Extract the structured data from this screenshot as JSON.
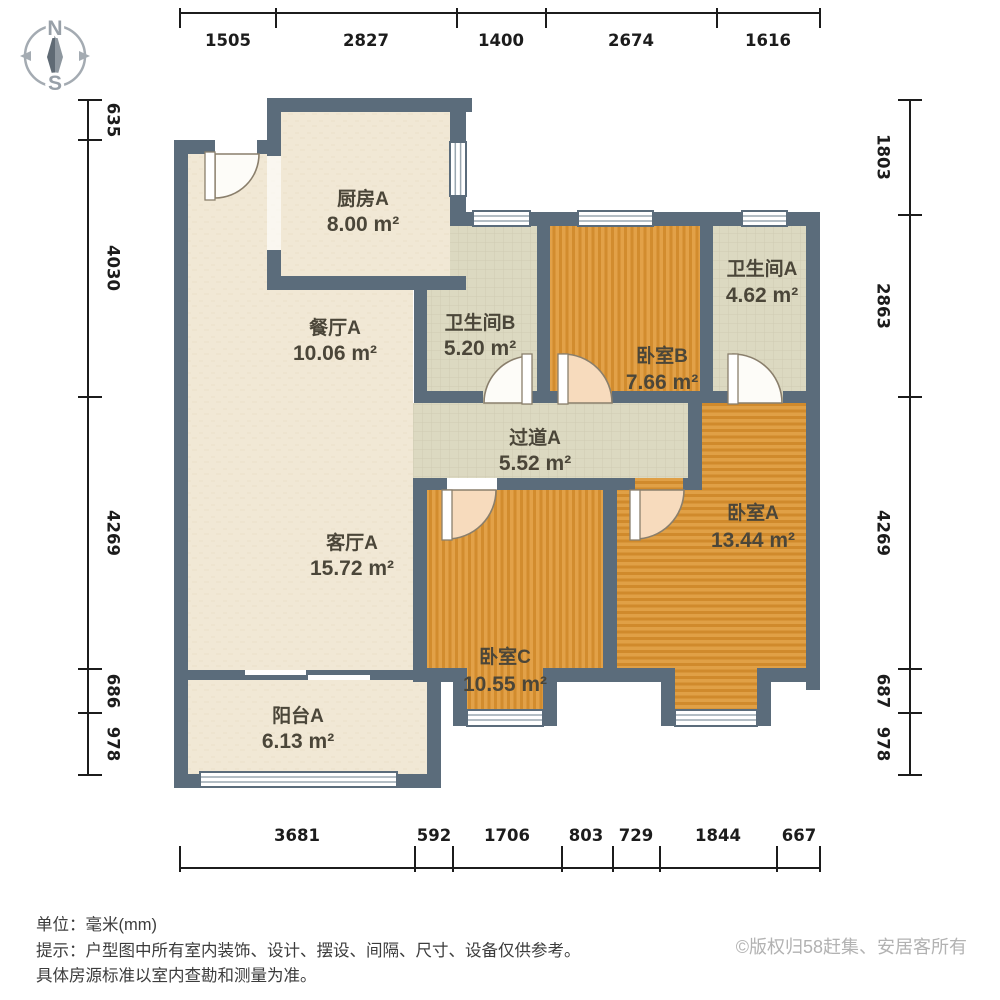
{
  "compass": {
    "n": "N",
    "s": "S"
  },
  "rulers": {
    "top": [
      "1505",
      "2827",
      "1400",
      "2674",
      "1616"
    ],
    "left": [
      "635",
      "4030",
      "4269",
      "686",
      "978"
    ],
    "right": [
      "1803",
      "2863",
      "4269",
      "687",
      "978"
    ],
    "bottom": [
      "3681",
      "592",
      "1706",
      "803",
      "729",
      "1844",
      "667"
    ]
  },
  "rooms": {
    "kitchen": {
      "name": "厨房A",
      "area": "8.00 m²"
    },
    "dining": {
      "name": "餐厅A",
      "area": "10.06 m²"
    },
    "bath_b": {
      "name": "卫生间B",
      "area": "5.20 m²"
    },
    "bath_a": {
      "name": "卫生间A",
      "area": "4.62 m²"
    },
    "bed_b": {
      "name": "卧室B",
      "area": "7.66 m²"
    },
    "hallway": {
      "name": "过道A",
      "area": "5.52 m²"
    },
    "bed_a": {
      "name": "卧室A",
      "area": "13.44 m²"
    },
    "living": {
      "name": "客厅A",
      "area": "15.72 m²"
    },
    "bed_c": {
      "name": "卧室C",
      "area": "10.55 m²"
    },
    "balcony": {
      "name": "阳台A",
      "area": "6.13 m²"
    }
  },
  "footer": {
    "unit": "单位：毫米(mm)",
    "tip": "提示：户型图中所有室内装饰、设计、摆设、间隔、尺寸、设备仅供参考。",
    "tip2": "具体房源标准以室内查勘和测量为准。",
    "copyright": "©版权归58赶集、安居客所有"
  },
  "colors": {
    "wall": "#5b6c7b",
    "floor_cream": "#f1e8d5",
    "floor_tile": "#dcd9c1",
    "wood_light": "#e2a148",
    "wood_dark": "#d28c2e",
    "door_fill": "#f7dbbd"
  }
}
